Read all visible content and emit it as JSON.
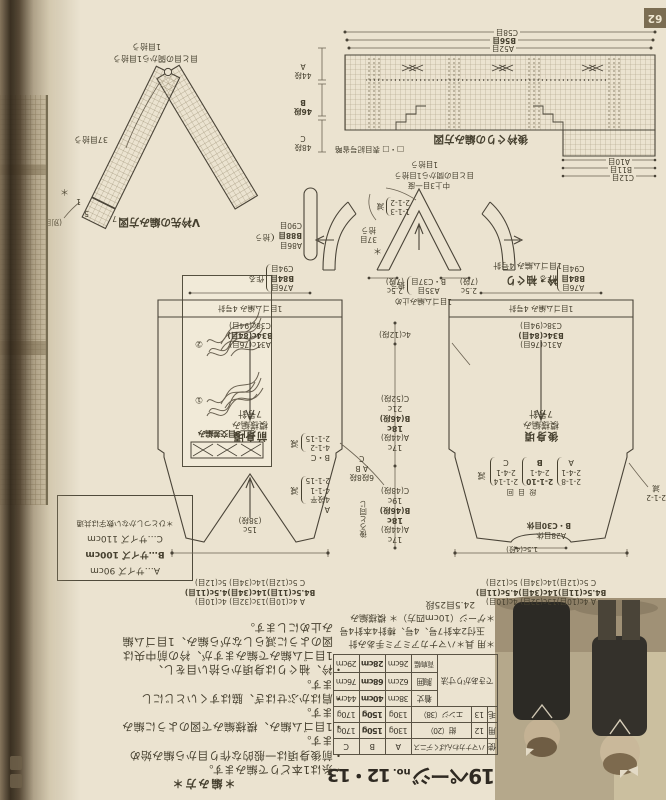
{
  "page": {
    "number": "62",
    "bg_color": "#ebe3d0",
    "ink_color": "#46402f",
    "highlight_size": "B"
  },
  "title": {
    "page_word": "19ページ",
    "no_label": "no.",
    "numbers": "12・13"
  },
  "materials": {
    "col_head_chars": [
      "使",
      "用",
      "毛"
    ],
    "yarn_name": "ハマナカわんぱくデニス",
    "size_headers": [
      "A",
      "B",
      "C"
    ],
    "yarn_rows": [
      {
        "no": "12",
        "color": "紺（20）",
        "a": "130g",
        "b": "150g",
        "c": "170g"
      },
      {
        "no": "13",
        "color": "エンジ（38）",
        "a": "130g",
        "b": "150g",
        "c": "170g"
      }
    ],
    "finished_label": "できあがり寸法",
    "finished_rows": [
      {
        "name": "着丈",
        "a": "38cm",
        "b": "40cm",
        "c": "44cm"
      },
      {
        "name": "胸囲",
        "a": "62cm",
        "b": "68cm",
        "c": "76cm"
      },
      {
        "name": "背肩幅",
        "a": "26cm",
        "b": "28cm",
        "c": "29cm"
      }
    ]
  },
  "tools_gauge": {
    "line1": "＊用 具＊ハマナカアミアミ手あみ針",
    "line2": "玉付2本針7号、4号、棒針4本針4号",
    "line3": "＊ゲージ（10cm四方）＊ 模様編み",
    "line4": "24.5目25段"
  },
  "howto": {
    "heading": "＊編み方＊",
    "lines": [
      "・糸は1本どりで編みます。",
      "・前後身頃は一般的な作り目から編み始め",
      "ます。",
      "・1目ゴム編み、模様編みで図のように編み",
      "ます。",
      "・肩はかぶせはぎ、脇はすくいとじにし",
      "ます。",
      "・衿、袖ぐりは身頃から拾い目をし、",
      "1目ゴム編みで編みますが、衿の前中央は",
      "図のように減らしながら編み、1目ゴム編",
      "み止めにします。"
    ]
  },
  "sizes_box": {
    "a": "A…サイズ 90cm",
    "b": "B…サイズ 100cm",
    "c": "C…サイズ 110cm",
    "note": "＊ひとつしかない数字は共通"
  },
  "cable_box": {
    "caption": "左上3目交差編み",
    "step1": "①",
    "step2": "②"
  },
  "front": {
    "caption1": "前身頃",
    "caption2": "模様編み",
    "caption3": "7号針",
    "rib": "1目ゴム編み 4号針",
    "top_widths": [
      "A 4c(10目)13c(32目) 4c(10目)",
      "B4.5c(11目)14c(34目)4.5c(11目)",
      "C 5c(12目)14c(34目) 5c(12目)"
    ],
    "hem_widths": [
      "A31c(76目)",
      "B34c(84目)",
      "C38c(94目)"
    ],
    "caston": [
      "A76目",
      "B84目",
      "C94目"
    ],
    "caston_word": "作る",
    "v_depth1": "15c",
    "v_depth2": "(38段)",
    "dec_a_size": "A",
    "dec_a": [
      "4段平",
      "4-1-1",
      "2-1-15"
    ],
    "dec_bc_size": "B・C",
    "dec_bc": [
      "4-1-2",
      "2-1-15"
    ],
    "dec_word": "減",
    "shoulder1": "6段8段",
    "shoulder2": "A B",
    "shoulder3": "C",
    "same_as_back": "後ろと同じ"
  },
  "back": {
    "caption1": "後身頃",
    "caption2": "模様編み",
    "caption3": "7号針",
    "rib": "1目ゴム編み 4号針",
    "top_widths": [
      "A 4c(10目)13c(32目) 4c(10目)",
      "B4.5c(11目)14c(34目)4.5c(11目)",
      "C 5c(12目)14c(34目) 5c(12目)"
    ],
    "hem_widths": [
      "A31c(76目)",
      "B34c(84目)",
      "C38c(94目)"
    ],
    "caston": [
      "A76目",
      "B84目",
      "C94目"
    ],
    "caston_word": "作る",
    "neck_depth": "1.5c(4段)",
    "hold_a": "A28目休",
    "hold_bc": "B・C30目休",
    "dec_header": "段 目 回",
    "dec_cols": [
      {
        "size": "A",
        "l1": "2-1-8",
        "l2": "2-4-1"
      },
      {
        "size": "B",
        "l1": "2-1-10",
        "l2": "2-4-1"
      },
      {
        "size": "C",
        "l1": "2-1-14",
        "l2": "2-4-1"
      }
    ],
    "dec_word": "減",
    "armhole_dec1": "2-1-2",
    "armhole_dec2": "減"
  },
  "center_dims": {
    "upper": [
      "17c",
      "A(44段)",
      "18c",
      "B(46段)",
      "19c",
      "C(48段)"
    ],
    "lower": [
      "17c",
      "A(44段)",
      "18c",
      "B(46段)",
      "21c",
      "C(52段)"
    ],
    "rib": "4c(12段)"
  },
  "collar": {
    "caption1": "衿・袖ぐり",
    "caption2": "1目ゴム編み 4号針",
    "star": "＊",
    "arm1": "37目",
    "arm2": "拾う",
    "dec1": "1-1-3",
    "dec2": "2-1-2",
    "dec_word": "減",
    "apex1": "中上3目一度",
    "apex2": "目と目の間から1目拾う",
    "apex3": "1目拾う",
    "left1": "2.5c",
    "left2": "(7段)",
    "right1": "2.5c",
    "right2": "(7段)",
    "pick1": "A35目",
    "pick2": "B・C37目",
    "pick_word": "拾う",
    "bindoff": "1目ゴム編み止め",
    "band": [
      "A86目",
      "B88目",
      "C90目"
    ],
    "band_word": "拾う"
  },
  "vneck_chart": {
    "caption": "V衿先の編み方図",
    "pick_between": "目と目の間から1目拾う",
    "pick1": "1目拾う",
    "pick37": "37目拾う",
    "star": "＊",
    "note": "(別目)",
    "n7": "7",
    "n5": "5",
    "n1": "1"
  },
  "backneck_chart": {
    "caption": "後衿ぐりの編み方図",
    "legend": "□・□ 表目記号省略",
    "bottom_widths": [
      "A52目",
      "B56目",
      "C58目"
    ],
    "top_widths": [
      "C12目",
      "B11目",
      "A10目"
    ]
  },
  "armhole_rows": [
    {
      "rows": "48段",
      "size": "C"
    },
    {
      "rows": "46段",
      "size": "B"
    },
    {
      "rows": "44段",
      "size": "A"
    }
  ]
}
